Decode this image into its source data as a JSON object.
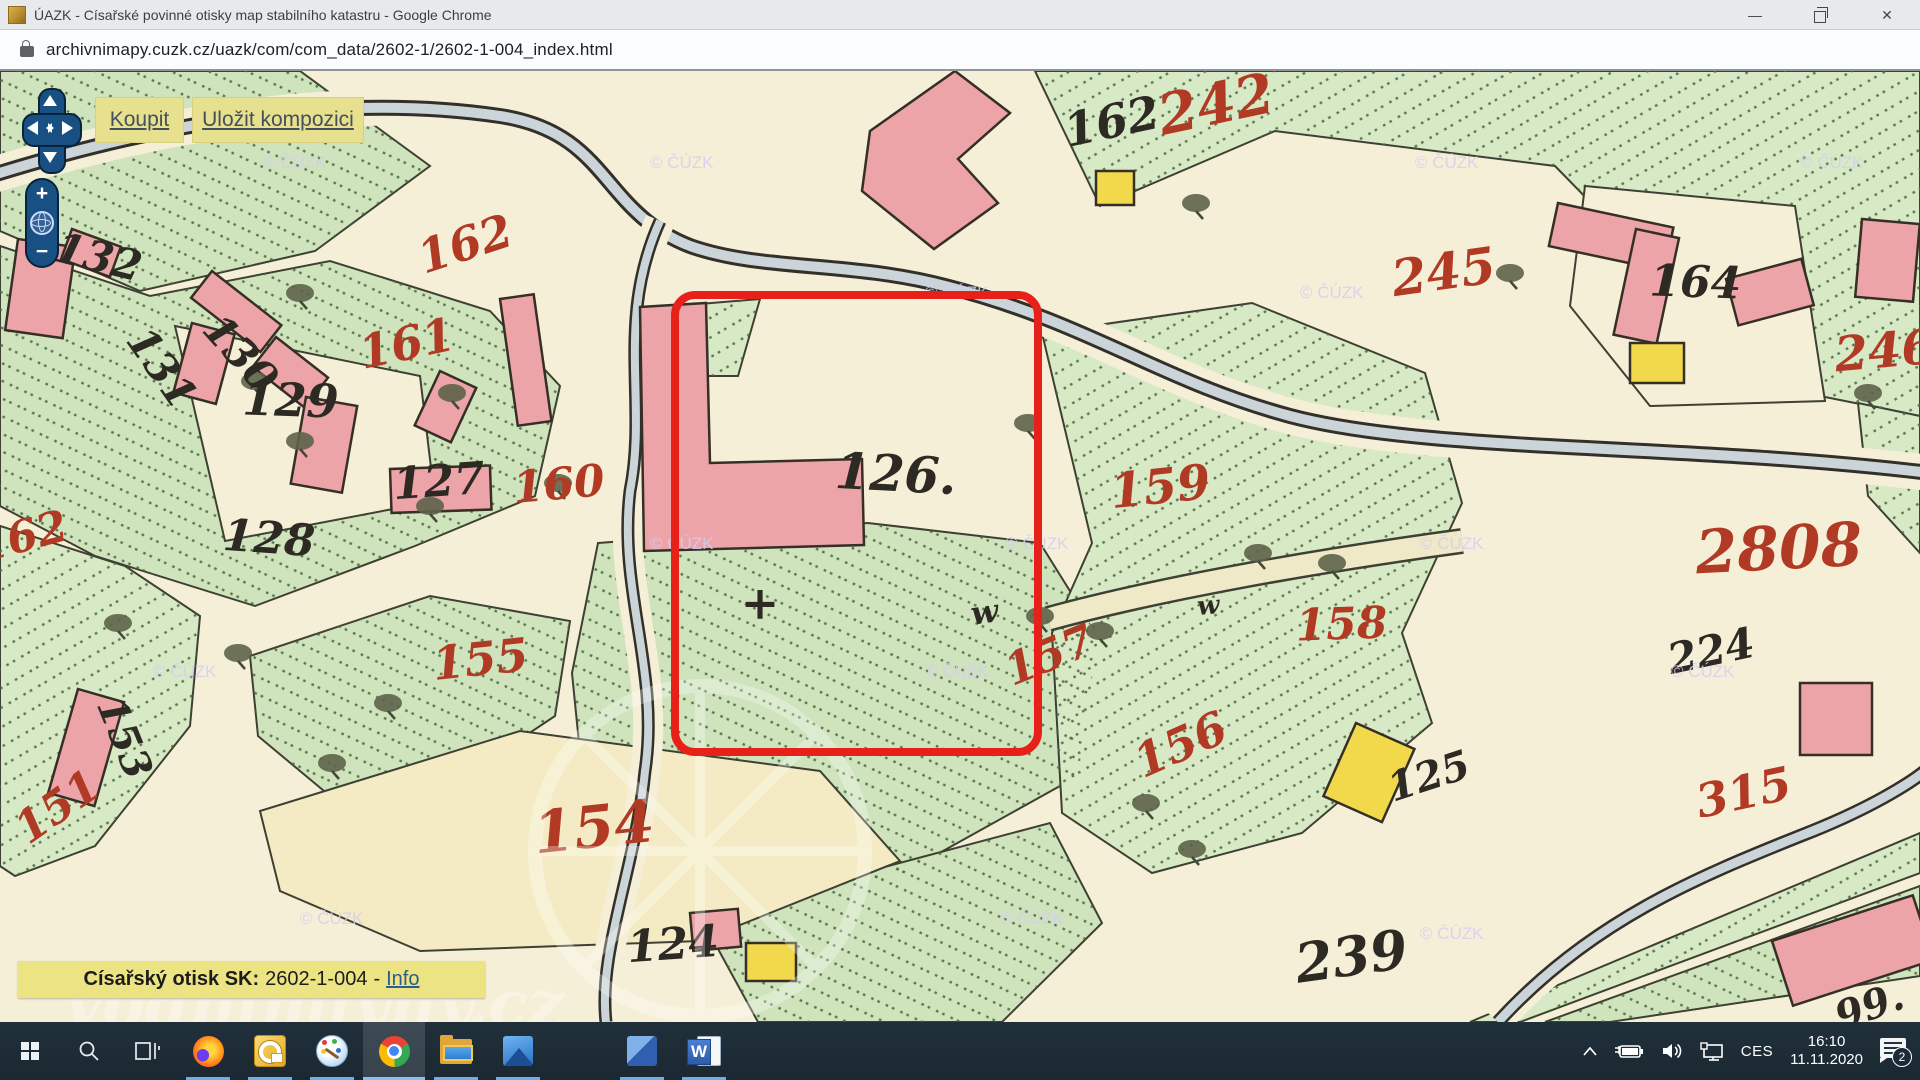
{
  "window": {
    "title": "ÚAZK - Císařské povinné otisky map stabilního katastru - Google Chrome",
    "controls": {
      "minimize": "—",
      "close": "✕"
    }
  },
  "urlbar": {
    "url": "archivnimapy.cuzk.cz/uazk/com/com_data/2602-1/2602-1-004_index.html"
  },
  "toolbar": {
    "buy": "Koupit",
    "save": "Uložit kompozici"
  },
  "nav_widget": {
    "zoom_in": "+",
    "zoom_out": "−"
  },
  "info_bar": {
    "label": "Císařský otisk SK:",
    "value": "2602-1-004",
    "separator": "-",
    "link": "Info"
  },
  "map": {
    "highlighted_parcel": "126",
    "watermark": "© ČÚZK",
    "site_watermark": "vodnimlyny.cz",
    "colors": {
      "ink_black": "#2d2a24",
      "ink_red": "#b03a24",
      "highlight_red": "#e8201a",
      "parcel_green": "#cfe4bc",
      "building_pink": "#eda4a9",
      "building_yellow": "#f2d84b",
      "paper": "#f6efd8",
      "stream": "#cbd4d8",
      "watermark_color": "#d6cdf2"
    },
    "labels": [
      {
        "t": "162",
        "x": 1115,
        "y": 66,
        "s": 46,
        "r": -12,
        "c": "black"
      },
      {
        "t": "132",
        "x": 95,
        "y": 200,
        "s": 42,
        "r": 14,
        "c": "black"
      },
      {
        "t": "131",
        "x": 150,
        "y": 305,
        "s": 42,
        "r": 55,
        "c": "black"
      },
      {
        "t": "130",
        "x": 230,
        "y": 292,
        "s": 42,
        "r": 48,
        "c": "black"
      },
      {
        "t": "129",
        "x": 290,
        "y": 345,
        "s": 46,
        "r": 2,
        "c": "black"
      },
      {
        "t": "127",
        "x": 440,
        "y": 425,
        "s": 44,
        "r": -4,
        "c": "black"
      },
      {
        "t": "128",
        "x": 268,
        "y": 482,
        "s": 44,
        "r": 4,
        "c": "black"
      },
      {
        "t": "126.",
        "x": 895,
        "y": 420,
        "s": 50,
        "r": 3,
        "c": "black"
      },
      {
        "t": "153",
        "x": 112,
        "y": 672,
        "s": 40,
        "r": 68,
        "c": "black"
      },
      {
        "t": "124",
        "x": 674,
        "y": 888,
        "s": 44,
        "r": -4,
        "c": "black"
      },
      {
        "t": "164",
        "x": 1695,
        "y": 226,
        "s": 44,
        "r": 2,
        "c": "black"
      },
      {
        "t": "224",
        "x": 1714,
        "y": 594,
        "s": 42,
        "r": -12,
        "c": "black"
      },
      {
        "t": "239",
        "x": 1354,
        "y": 904,
        "s": 54,
        "r": -8,
        "c": "black"
      },
      {
        "t": "125",
        "x": 1433,
        "y": 718,
        "s": 40,
        "r": -18,
        "c": "black"
      },
      {
        "t": "99.",
        "x": 1874,
        "y": 948,
        "s": 40,
        "r": -20,
        "c": "black"
      },
      {
        "t": "w",
        "x": 986,
        "y": 552,
        "s": 32,
        "r": -8,
        "c": "black"
      },
      {
        "t": "w",
        "x": 1209,
        "y": 543,
        "s": 26,
        "r": -5,
        "c": "black"
      },
      {
        "t": "+",
        "x": 760,
        "y": 548,
        "s": 46,
        "r": 0,
        "c": "black"
      },
      {
        "t": "242",
        "x": 1220,
        "y": 52,
        "s": 56,
        "r": -12,
        "c": "red"
      },
      {
        "t": "245",
        "x": 1446,
        "y": 218,
        "s": 50,
        "r": -8,
        "c": "red"
      },
      {
        "t": "246",
        "x": 1886,
        "y": 296,
        "s": 48,
        "r": -5,
        "c": "red"
      },
      {
        "t": "162",
        "x": 470,
        "y": 188,
        "s": 46,
        "r": -18,
        "c": "red"
      },
      {
        "t": "161",
        "x": 410,
        "y": 288,
        "s": 46,
        "r": -12,
        "c": "red"
      },
      {
        "t": "160",
        "x": 560,
        "y": 428,
        "s": 44,
        "r": -5,
        "c": "red"
      },
      {
        "t": "162",
        "x": 26,
        "y": 480,
        "s": 44,
        "r": -15,
        "c": "red"
      },
      {
        "t": "159",
        "x": 1162,
        "y": 432,
        "s": 48,
        "r": -6,
        "c": "red"
      },
      {
        "t": "158",
        "x": 1342,
        "y": 568,
        "s": 44,
        "r": -2,
        "c": "red"
      },
      {
        "t": "157",
        "x": 1055,
        "y": 598,
        "s": 44,
        "r": -22,
        "c": "red"
      },
      {
        "t": "156",
        "x": 1187,
        "y": 688,
        "s": 46,
        "r": -24,
        "c": "red"
      },
      {
        "t": "155",
        "x": 482,
        "y": 604,
        "s": 46,
        "r": -6,
        "c": "red"
      },
      {
        "t": "154",
        "x": 596,
        "y": 776,
        "s": 58,
        "r": -6,
        "c": "red"
      },
      {
        "t": "151",
        "x": 66,
        "y": 748,
        "s": 44,
        "r": -35,
        "c": "red"
      },
      {
        "t": "315",
        "x": 1747,
        "y": 737,
        "s": 46,
        "r": -12,
        "c": "red"
      },
      {
        "t": "2808",
        "x": 1780,
        "y": 498,
        "s": 60,
        "r": -3,
        "c": "red"
      }
    ],
    "watermarks": [
      [
        263,
        97
      ],
      [
        650,
        97
      ],
      [
        1415,
        97
      ],
      [
        1800,
        97
      ],
      [
        925,
        227
      ],
      [
        1300,
        227
      ],
      [
        650,
        478
      ],
      [
        1005,
        478
      ],
      [
        1420,
        478
      ],
      [
        153,
        606
      ],
      [
        925,
        606
      ],
      [
        1671,
        606
      ],
      [
        300,
        853
      ],
      [
        1000,
        853
      ],
      [
        1420,
        868
      ]
    ],
    "trees": [
      [
        300,
        222
      ],
      [
        452,
        322
      ],
      [
        255,
        310
      ],
      [
        300,
        370
      ],
      [
        430,
        435
      ],
      [
        118,
        552
      ],
      [
        238,
        582
      ],
      [
        388,
        632
      ],
      [
        332,
        692
      ],
      [
        558,
        412
      ],
      [
        1028,
        352
      ],
      [
        1100,
        560
      ],
      [
        1040,
        545
      ],
      [
        1258,
        482
      ],
      [
        1332,
        492
      ],
      [
        1196,
        132
      ],
      [
        1510,
        202
      ],
      [
        1868,
        322
      ],
      [
        1146,
        732
      ],
      [
        1192,
        778
      ]
    ]
  },
  "taskbar": {
    "tray": {
      "language": "CES",
      "time": "16:10",
      "date": "11.11.2020",
      "notification_count": "2"
    },
    "apps": [
      {
        "id": "firefox",
        "running": true,
        "active": false
      },
      {
        "id": "outlook",
        "running": true,
        "active": false
      },
      {
        "id": "paint",
        "running": true,
        "active": false
      },
      {
        "id": "chrome",
        "running": true,
        "active": true
      },
      {
        "id": "explorer",
        "running": true,
        "active": false
      },
      {
        "id": "photos",
        "running": true,
        "active": false
      },
      {
        "id": "media",
        "running": true,
        "active": false,
        "gap_before": true
      },
      {
        "id": "word",
        "running": true,
        "active": false,
        "letter": "W"
      }
    ]
  }
}
